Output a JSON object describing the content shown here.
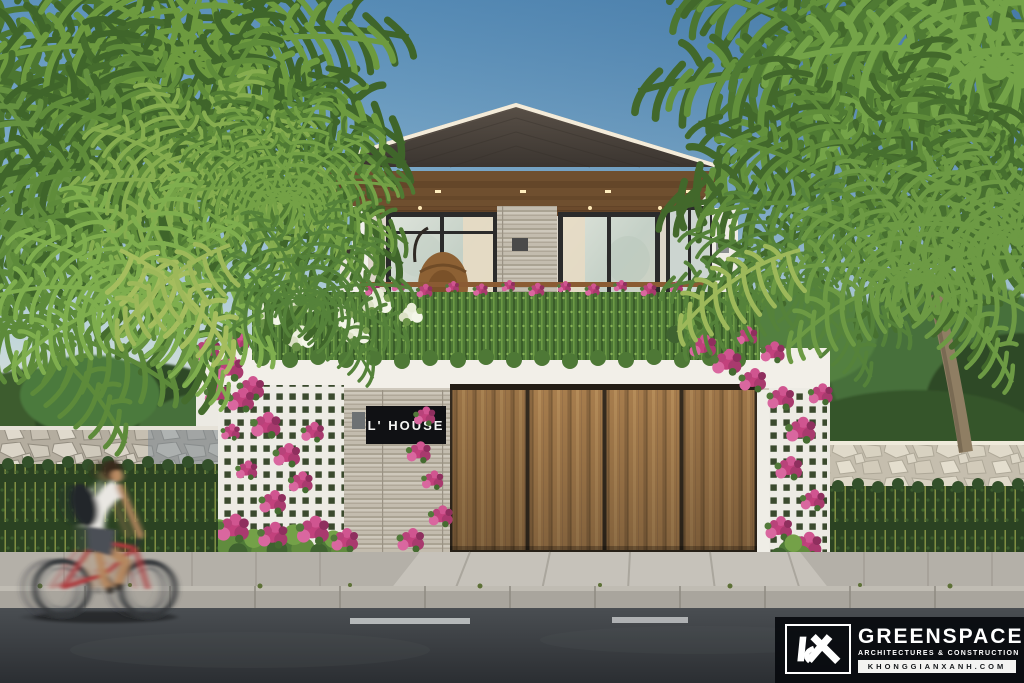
{
  "scene": {
    "description": "Front elevation architectural render of a modern two-storey tropical house with palm trees, bougainvillea, perimeter stone fence, hedge, sidewalk, asphalt road and a motion-blurred cyclist passing by.",
    "house_sign": "L' HOUSE"
  },
  "watermark": {
    "brand": "GREENSPACE",
    "tagline": "ARCHITECTURES & CONSTRUCTION",
    "website": "KHONGGIANXANH.COM",
    "logo_icon": "kx-monogram-icon"
  },
  "colors": {
    "sky_top": "#4e83b0",
    "sky_horizon": "#f1ebdc",
    "roof": "#473f38",
    "soffit_wood": "#6f4f2f",
    "wall_white": "#f3f1ec",
    "stone_cladding": "#b6afa1",
    "garage_wood": "#a77d4d",
    "lattice_white": "#edebe4",
    "foliage_dark": "#3f652a",
    "foliage_light": "#74a148",
    "bougainvillea_pink": "#c74d86",
    "hedge_green": "#2b4222",
    "fence_stone": "#cdc7ba",
    "road_asphalt": "#33373b",
    "lane_marking": "#c9cccd",
    "sign_bg": "#101114",
    "sign_text": "#f5f5f3",
    "watermark_bg": "#0a0d11",
    "watermark_text": "#ffffff",
    "bicycle_red": "#ad3a3c"
  }
}
